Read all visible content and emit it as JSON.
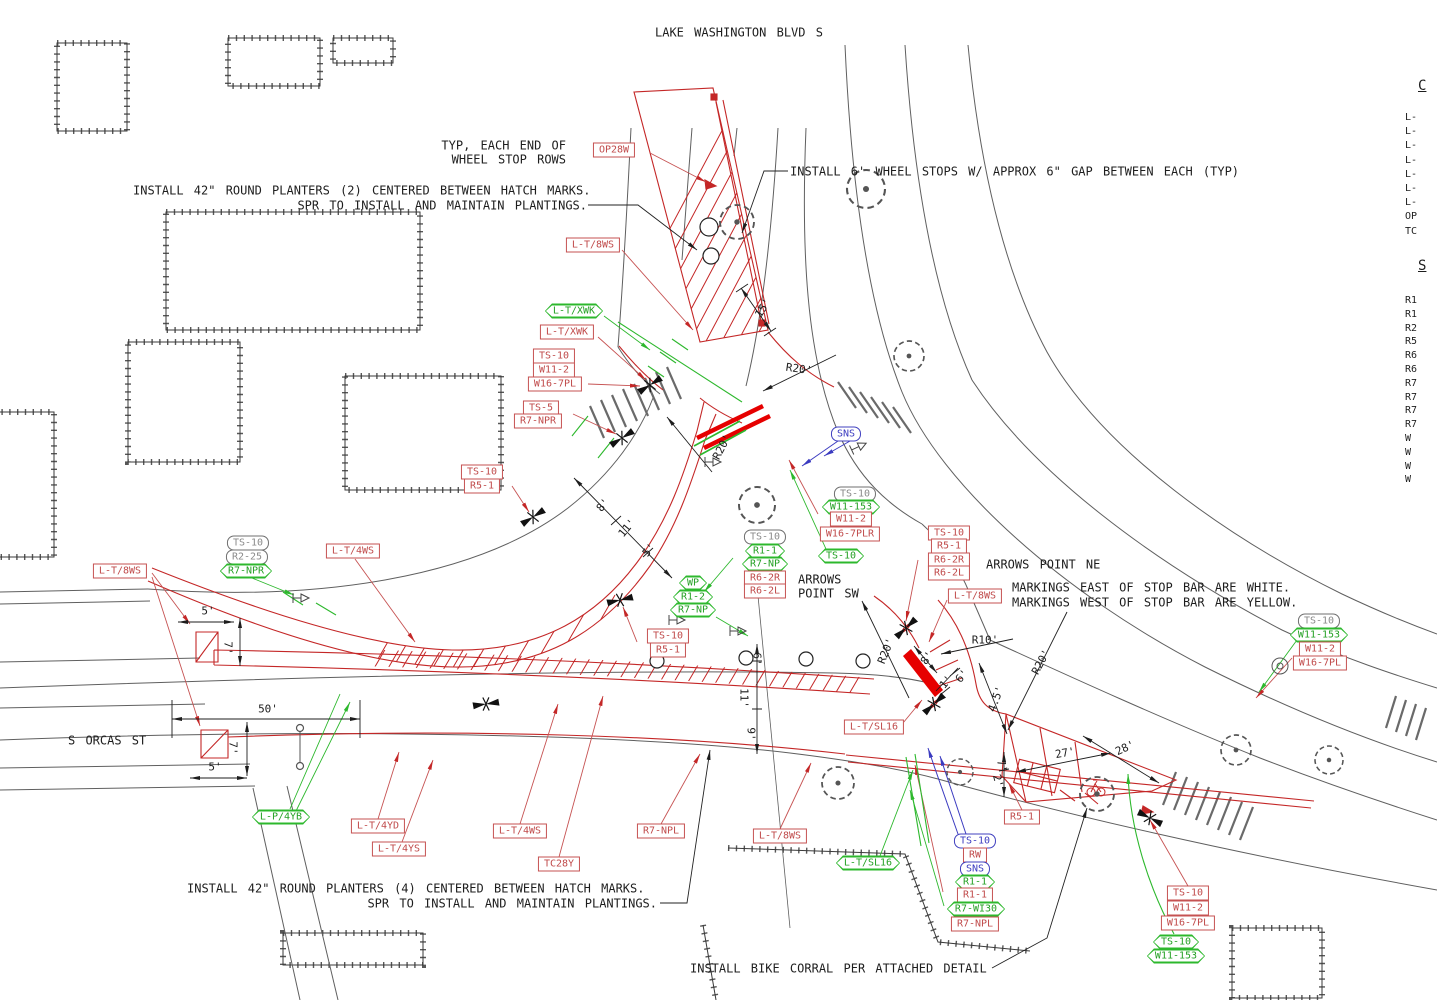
{
  "colors": {
    "red_line": "#c42727",
    "bright_red": "#e60000",
    "green": "#2db82d",
    "blue": "#3b3bc0",
    "gray_label": "#8a8a8a",
    "black": "#1d1d1d",
    "road_gray": "#5f5f5f"
  },
  "notes": [
    {
      "name": "street-title-lake-washington",
      "t": "LAKE WASHINGTON BLVD S",
      "x": 655,
      "y": 33
    },
    {
      "name": "note-typ-line1",
      "t": "TYP, EACH END OF",
      "x": 566,
      "y": 146,
      "a": "right"
    },
    {
      "name": "note-typ-line2",
      "t": "WHEEL STOP ROWS",
      "x": 566,
      "y": 160,
      "a": "right"
    },
    {
      "name": "note-wheel-stops",
      "t": "INSTALL 6' WHEEL STOPS W/ APPROX 6\" GAP BETWEEN EACH (TYP)",
      "x": 790,
      "y": 172
    },
    {
      "name": "note-planters-2-line1",
      "t": "INSTALL 42\" ROUND PLANTERS (2) CENTERED BETWEEN HATCH MARKS.",
      "x": 133,
      "y": 191
    },
    {
      "name": "note-planters-2-line2",
      "t": "SPR TO INSTALL AND MAINTAIN PLANTINGS.",
      "x": 587,
      "y": 206,
      "a": "right"
    },
    {
      "name": "note-arrows-ne",
      "t": "ARROWS POINT NE",
      "x": 986,
      "y": 565
    },
    {
      "name": "note-markings-east",
      "t": "MARKINGS EAST OF STOP BAR ARE WHITE.",
      "x": 1012,
      "y": 588
    },
    {
      "name": "note-markings-west",
      "t": "MARKINGS WEST OF STOP BAR ARE YELLOW.",
      "x": 1012,
      "y": 603
    },
    {
      "name": "note-arrows-sw-line1",
      "t": "ARROWS",
      "x": 798,
      "y": 580
    },
    {
      "name": "note-arrows-sw-line2",
      "t": "POINT SW",
      "x": 798,
      "y": 594
    },
    {
      "name": "street-title-s-orcas",
      "t": "S ORCAS ST",
      "x": 68,
      "y": 741
    },
    {
      "name": "note-planters-4-line1",
      "t": "INSTALL 42\" ROUND PLANTERS (4) CENTERED BETWEEN HATCH MARKS.",
      "x": 187,
      "y": 889
    },
    {
      "name": "note-planters-4-line2",
      "t": "SPR TO INSTALL AND MAINTAIN PLANTINGS.",
      "x": 657,
      "y": 904,
      "a": "right"
    },
    {
      "name": "note-bike-corral",
      "t": "INSTALL BIKE CORRAL PER ATTACHED DETAIL",
      "x": 690,
      "y": 969
    }
  ],
  "dims": [
    {
      "t": "15'",
      "x": 763,
      "y": 308,
      "r": -58
    },
    {
      "t": "R20'",
      "x": 799,
      "y": 369,
      "r": 8
    },
    {
      "t": "R20'",
      "x": 722,
      "y": 447,
      "r": -62
    },
    {
      "t": "8'",
      "x": 603,
      "y": 505,
      "r": -50
    },
    {
      "t": "11'",
      "x": 627,
      "y": 528,
      "r": -50
    },
    {
      "t": "5'",
      "x": 649,
      "y": 550,
      "r": -50
    },
    {
      "t": "5'",
      "x": 208,
      "y": 611,
      "r": 0
    },
    {
      "t": "7'",
      "x": 228,
      "y": 648,
      "r": 90
    },
    {
      "t": "50'",
      "x": 268,
      "y": 709,
      "r": 0
    },
    {
      "t": "7'",
      "x": 233,
      "y": 748,
      "r": 90
    },
    {
      "t": "5'",
      "x": 215,
      "y": 767,
      "r": 0
    },
    {
      "t": "R20'",
      "x": 886,
      "y": 651,
      "r": -68
    },
    {
      "t": "R10'",
      "x": 985,
      "y": 640,
      "r": 0
    },
    {
      "t": "8'",
      "x": 927,
      "y": 658,
      "r": -55
    },
    {
      "t": "1'",
      "x": 946,
      "y": 682,
      "r": -50
    },
    {
      "t": "6'",
      "x": 962,
      "y": 676,
      "r": -50
    },
    {
      "t": "4.5'",
      "x": 996,
      "y": 699,
      "r": -70
    },
    {
      "t": "R20'",
      "x": 1041,
      "y": 662,
      "r": -62
    },
    {
      "t": "27'",
      "x": 1065,
      "y": 753,
      "r": -10
    },
    {
      "t": "28'",
      "x": 1125,
      "y": 748,
      "r": -25
    },
    {
      "t": "7'",
      "x": 1002,
      "y": 766,
      "r": 75
    },
    {
      "t": "2'",
      "x": 998,
      "y": 781,
      "r": 75
    },
    {
      "t": "6'",
      "x": 757,
      "y": 659,
      "r": 90
    },
    {
      "t": "11'",
      "x": 744,
      "y": 698,
      "r": 90
    },
    {
      "t": "9'",
      "x": 751,
      "y": 734,
      "r": 90
    }
  ],
  "tags": [
    {
      "t": "OP28W",
      "x": 614,
      "y": 150,
      "s": "red"
    },
    {
      "t": "L-T/8WS",
      "x": 593,
      "y": 245,
      "s": "red"
    },
    {
      "t": "L-T/XWK",
      "x": 574,
      "y": 311,
      "s": "green"
    },
    {
      "t": "L-T/XWK",
      "x": 567,
      "y": 332,
      "s": "red"
    },
    {
      "t": "TS-10",
      "x": 554,
      "y": 356,
      "s": "red"
    },
    {
      "t": "W11-2",
      "x": 554,
      "y": 370,
      "s": "red"
    },
    {
      "t": "W16-7PL",
      "x": 555,
      "y": 384,
      "s": "red"
    },
    {
      "t": "TS-5",
      "x": 541,
      "y": 408,
      "s": "red"
    },
    {
      "t": "R7-NPR",
      "x": 538,
      "y": 421,
      "s": "red"
    },
    {
      "t": "TS-10",
      "x": 482,
      "y": 472,
      "s": "red"
    },
    {
      "t": "R5-1",
      "x": 482,
      "y": 486,
      "s": "red"
    },
    {
      "t": "TS-10",
      "x": 248,
      "y": 543,
      "s": "gray"
    },
    {
      "t": "R2-25",
      "x": 247,
      "y": 557,
      "s": "gray"
    },
    {
      "t": "R7-NPR",
      "x": 246,
      "y": 571,
      "s": "green"
    },
    {
      "t": "L-T/8WS",
      "x": 120,
      "y": 571,
      "s": "red"
    },
    {
      "t": "L-T/4WS",
      "x": 353,
      "y": 551,
      "s": "red"
    },
    {
      "t": "WP",
      "x": 693,
      "y": 583,
      "s": "green"
    },
    {
      "t": "R1-2",
      "x": 693,
      "y": 597,
      "s": "green"
    },
    {
      "t": "R7-NP",
      "x": 693,
      "y": 610,
      "s": "green"
    },
    {
      "t": "TS-10",
      "x": 668,
      "y": 636,
      "s": "red"
    },
    {
      "t": "R5-1",
      "x": 668,
      "y": 650,
      "s": "red"
    },
    {
      "t": "SNS",
      "x": 846,
      "y": 434,
      "s": "blue"
    },
    {
      "t": "TS-10",
      "x": 765,
      "y": 537,
      "s": "gray"
    },
    {
      "t": "R1-1",
      "x": 765,
      "y": 551,
      "s": "green"
    },
    {
      "t": "R7-NP",
      "x": 765,
      "y": 564,
      "s": "green"
    },
    {
      "t": "R6-2R",
      "x": 765,
      "y": 578,
      "s": "red"
    },
    {
      "t": "R6-2L",
      "x": 765,
      "y": 591,
      "s": "red"
    },
    {
      "t": "TS-10",
      "x": 855,
      "y": 494,
      "s": "gray"
    },
    {
      "t": "W11-153",
      "x": 851,
      "y": 507,
      "s": "green"
    },
    {
      "t": "W11-2",
      "x": 851,
      "y": 519,
      "s": "red"
    },
    {
      "t": "W16-7PLR",
      "x": 850,
      "y": 534,
      "s": "red"
    },
    {
      "t": "TS-10",
      "x": 841,
      "y": 556,
      "s": "green"
    },
    {
      "t": "TS-10",
      "x": 949,
      "y": 533,
      "s": "red"
    },
    {
      "t": "R5-1",
      "x": 949,
      "y": 546,
      "s": "red"
    },
    {
      "t": "R6-2R",
      "x": 949,
      "y": 560,
      "s": "red"
    },
    {
      "t": "R6-2L",
      "x": 949,
      "y": 573,
      "s": "red"
    },
    {
      "t": "L-T/8WS",
      "x": 975,
      "y": 596,
      "s": "red"
    },
    {
      "t": "L-T/SL16",
      "x": 874,
      "y": 727,
      "s": "red"
    },
    {
      "t": "TS-10",
      "x": 1319,
      "y": 621,
      "s": "gray"
    },
    {
      "t": "W11-153",
      "x": 1319,
      "y": 635,
      "s": "green"
    },
    {
      "t": "W11-2",
      "x": 1320,
      "y": 649,
      "s": "red"
    },
    {
      "t": "W16-7PL",
      "x": 1320,
      "y": 663,
      "s": "red"
    },
    {
      "t": "L-P/4YB",
      "x": 281,
      "y": 817,
      "s": "green"
    },
    {
      "t": "L-T/4YD",
      "x": 378,
      "y": 826,
      "s": "red"
    },
    {
      "t": "L-T/4YS",
      "x": 399,
      "y": 849,
      "s": "red"
    },
    {
      "t": "L-T/4WS",
      "x": 520,
      "y": 831,
      "s": "red"
    },
    {
      "t": "TC28Y",
      "x": 559,
      "y": 864,
      "s": "red"
    },
    {
      "t": "R7-NPL",
      "x": 661,
      "y": 831,
      "s": "red"
    },
    {
      "t": "L-T/8WS",
      "x": 780,
      "y": 836,
      "s": "red"
    },
    {
      "t": "L-T/SL16",
      "x": 868,
      "y": 863,
      "s": "green"
    },
    {
      "t": "TS-10",
      "x": 975,
      "y": 841,
      "s": "blue"
    },
    {
      "t": "RW",
      "x": 975,
      "y": 855,
      "s": "red"
    },
    {
      "t": "SNS",
      "x": 975,
      "y": 869,
      "s": "blue"
    },
    {
      "t": "R1-1",
      "x": 975,
      "y": 882,
      "s": "green"
    },
    {
      "t": "R1-1",
      "x": 975,
      "y": 895,
      "s": "red"
    },
    {
      "t": "R7-WI30",
      "x": 976,
      "y": 909,
      "s": "green"
    },
    {
      "t": "R7-NPL",
      "x": 975,
      "y": 924,
      "s": "red"
    },
    {
      "t": "R5-1",
      "x": 1022,
      "y": 817,
      "s": "red"
    },
    {
      "t": "TS-10",
      "x": 1188,
      "y": 893,
      "s": "red"
    },
    {
      "t": "W11-2",
      "x": 1188,
      "y": 908,
      "s": "red"
    },
    {
      "t": "W16-7PL",
      "x": 1188,
      "y": 923,
      "s": "red"
    },
    {
      "t": "TS-10",
      "x": 1176,
      "y": 942,
      "s": "green"
    },
    {
      "t": "W11-153",
      "x": 1176,
      "y": 956,
      "s": "green"
    }
  ],
  "legend": {
    "section1": {
      "header": "C",
      "items": [
        "L-",
        "L-",
        "L-",
        "L-",
        "L-",
        "L-",
        "L-",
        "OP",
        "TC"
      ]
    },
    "section2": {
      "header": "S",
      "items": [
        "R1",
        "R1",
        "R2",
        "R5",
        "R6",
        "R6",
        "R7",
        "R7",
        "R7",
        "R7",
        "W",
        "W",
        "W",
        "W"
      ]
    }
  }
}
